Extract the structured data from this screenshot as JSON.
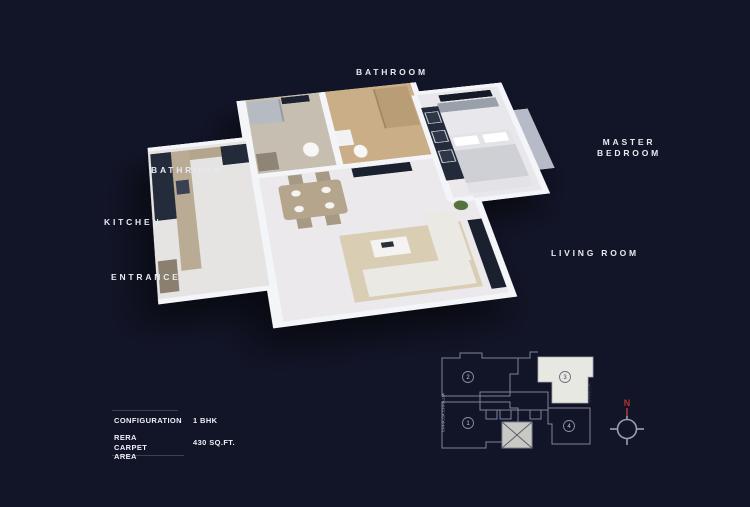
{
  "scene": {
    "background": "#121528",
    "description": "3D isometric floor plan of 1 BHK apartment on dark navy background"
  },
  "room_labels": {
    "bathroom_top": "BATHROOM",
    "bathroom_left": "BATHROOM",
    "kitchen": "KITCHEN",
    "entrance": "ENTRANCE",
    "master_bedroom_line1": "MASTER",
    "master_bedroom_line2": "BEDROOM",
    "living_room": "LIVING ROOM"
  },
  "config_table": {
    "rows": [
      {
        "label": "CONFIGURATION",
        "value": "1 BHK"
      },
      {
        "label": "RERA CARPET AREA",
        "value": "430 SQ.FT."
      }
    ]
  },
  "key_plan": {
    "units": [
      {
        "number": "1"
      },
      {
        "number": "2"
      },
      {
        "number": "3"
      },
      {
        "number": "4"
      }
    ],
    "highlighted_unit": "3",
    "highlight_color": "#e8e8e3",
    "line_color": "#7e8498",
    "edge_label_left": "CHHAJJA CHHAJJA",
    "edge_label_right": "CHHAJJA"
  },
  "compass": {
    "north_label": "N",
    "north_color": "#b5342c"
  }
}
